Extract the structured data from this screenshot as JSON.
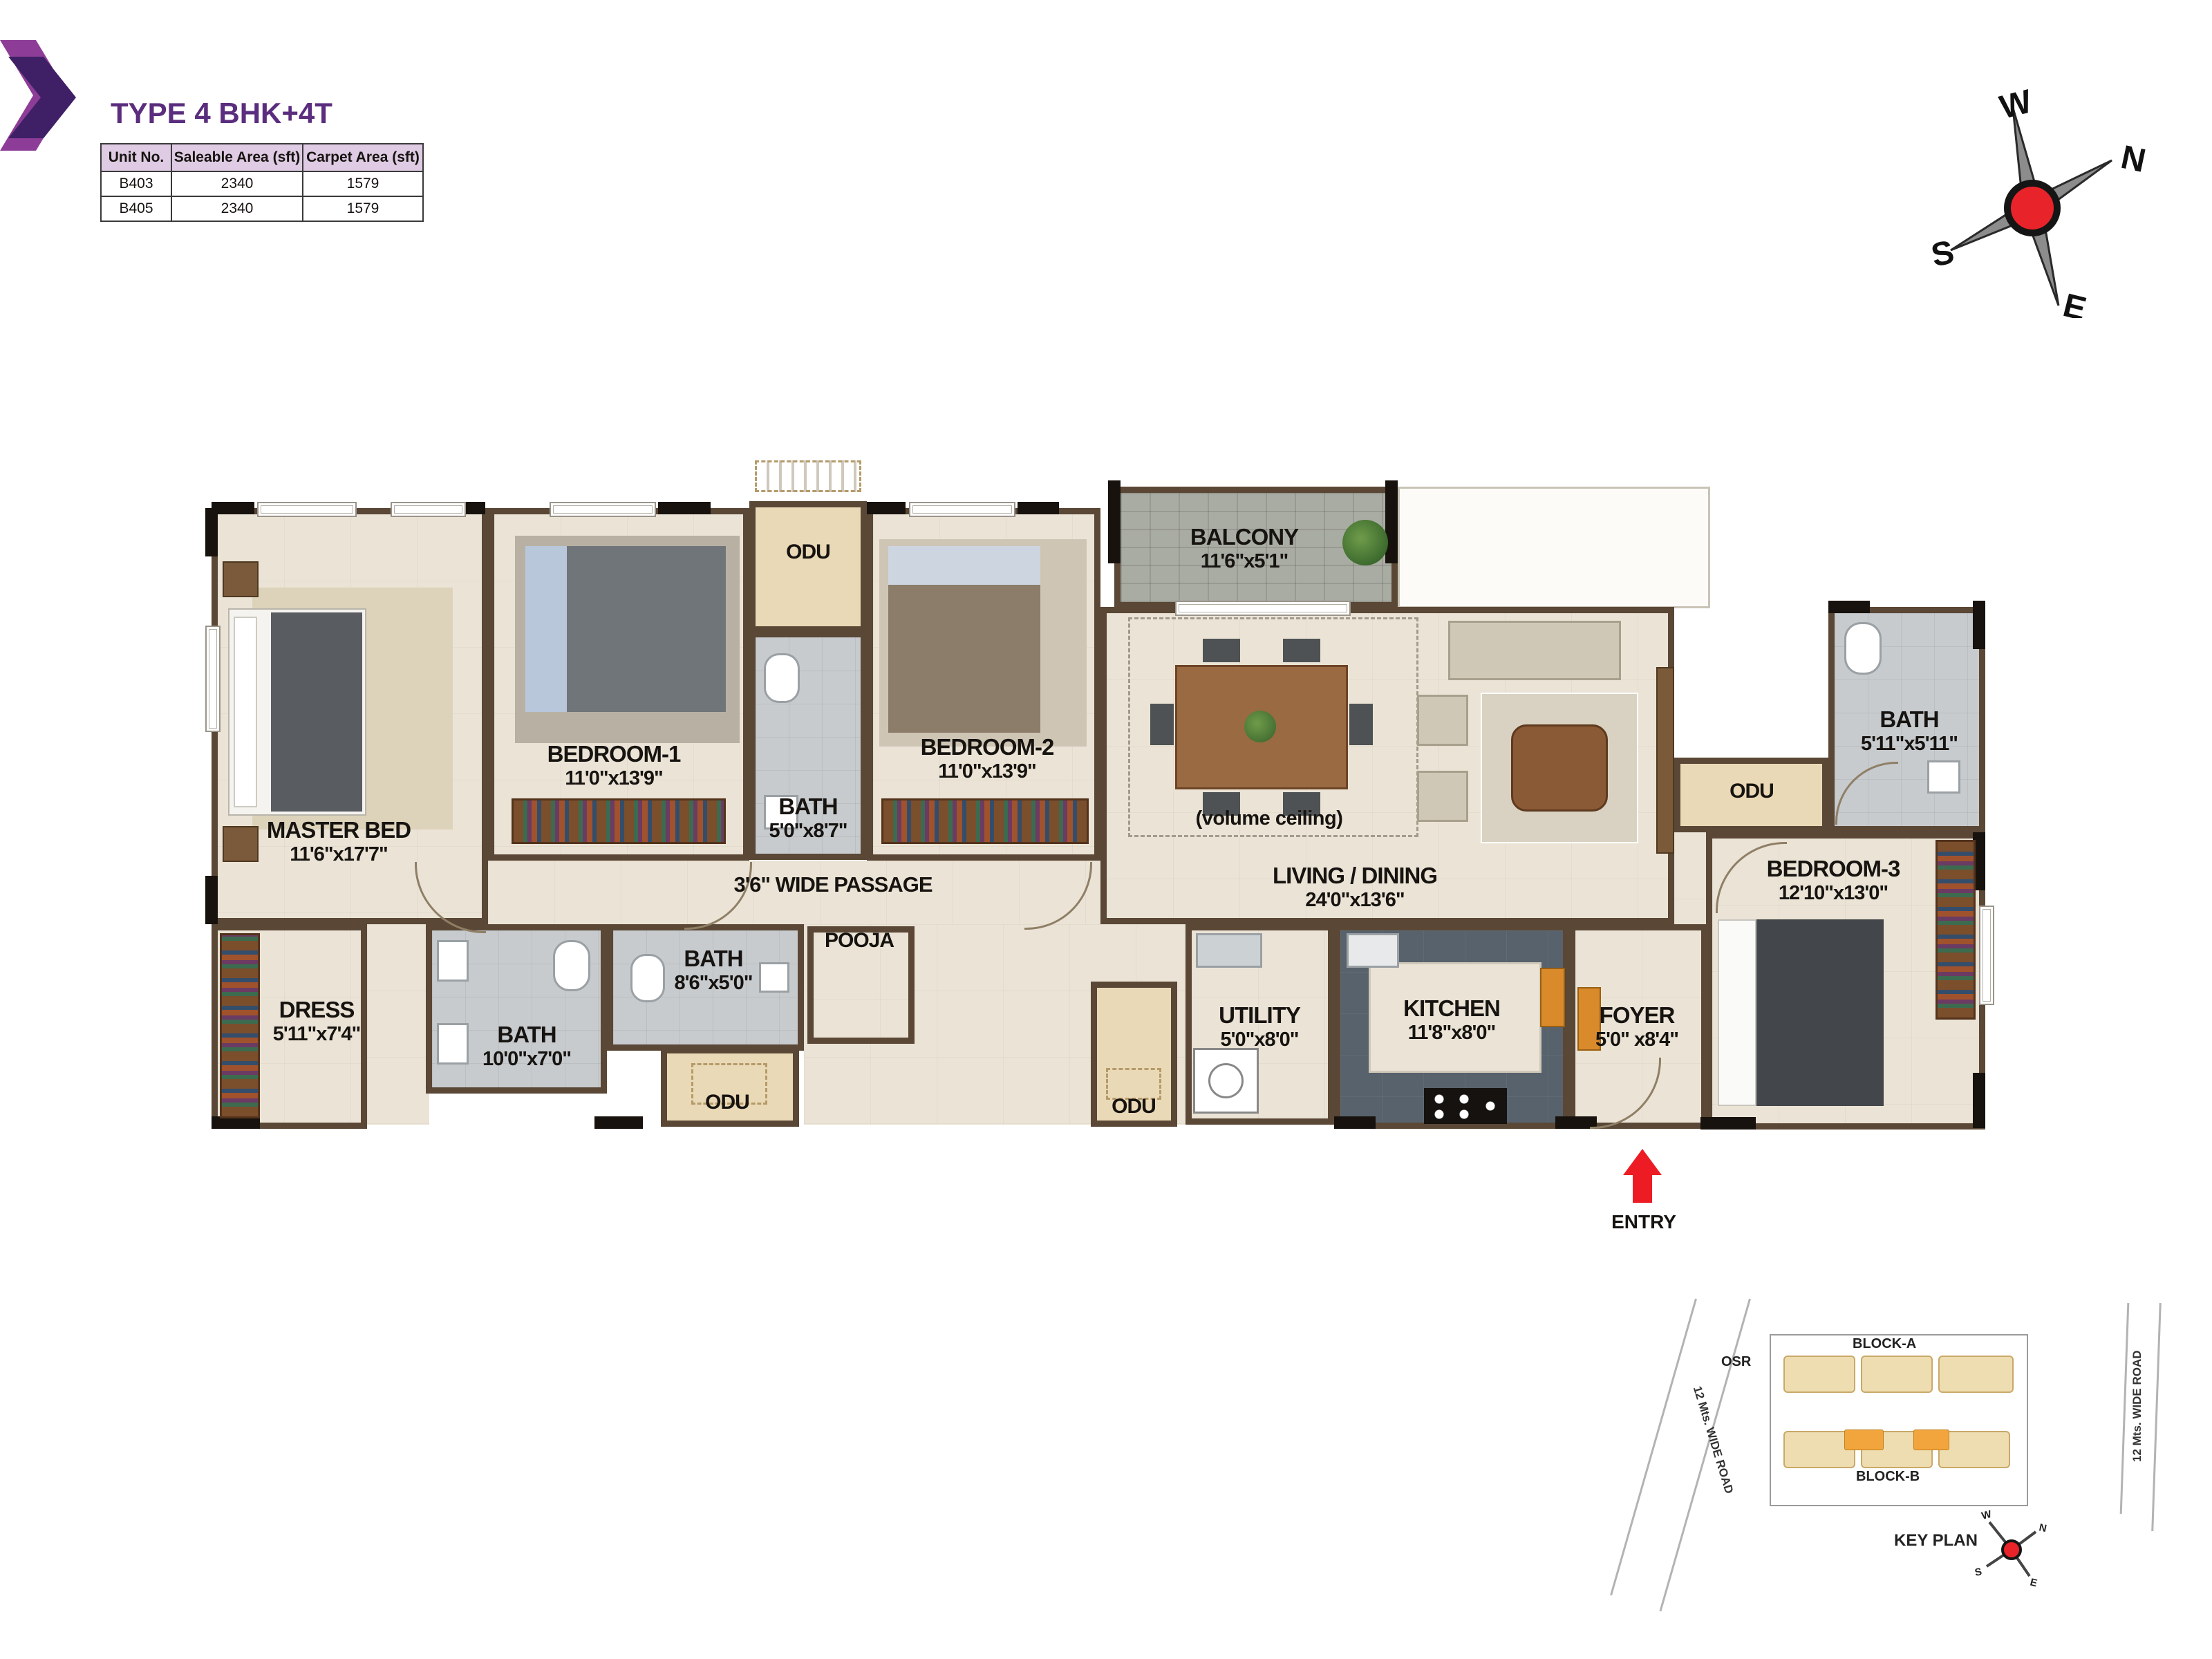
{
  "colors": {
    "accent_purple": "#5b2d7e",
    "table_header_bg": "#dfcbe3",
    "entry_red": "#ed1c24",
    "compass_red": "#e82329",
    "wall_brown": "#5a4735",
    "odu_beige": "#ead9b6",
    "bath_gray": "#c7cbce",
    "keyplan_highlight_orange": "#f2a53d"
  },
  "header": {
    "title": "TYPE 4 BHK+4T"
  },
  "table": {
    "headers": [
      "Unit No.",
      "Saleable Area (sft)",
      "Carpet Area (sft)"
    ],
    "rows": [
      [
        "B403",
        "2340",
        "1579"
      ],
      [
        "B405",
        "2340",
        "1579"
      ]
    ]
  },
  "compass": {
    "n": "N",
    "s": "S",
    "e": "E",
    "w": "W"
  },
  "plan": {
    "rooms": {
      "master_bed": {
        "name": "MASTER BED",
        "size": "11'6\"x17'7\""
      },
      "bedroom1": {
        "name": "BEDROOM-1",
        "size": "11'0\"x13'9\""
      },
      "bedroom2": {
        "name": "BEDROOM-2",
        "size": "11'0\"x13'9\""
      },
      "bedroom3": {
        "name": "BEDROOM-3",
        "size": "12'10\"x13'0\""
      },
      "bath_mid": {
        "name": "BATH",
        "size": "5'0\"x8'7\""
      },
      "bath_master": {
        "name": "BATH",
        "size": "10'0\"x7'0\""
      },
      "bath_common": {
        "name": "BATH",
        "size": "8'6\"x5'0\""
      },
      "bath3": {
        "name": "BATH",
        "size": "5'11\"x5'11\""
      },
      "balcony": {
        "name": "BALCONY",
        "size": "11'6\"x5'1\""
      },
      "living_dining": {
        "name": "LIVING / DINING",
        "size": "24'0\"x13'6\"",
        "note": "(volume ceiling)"
      },
      "passage": {
        "name": "3'6\" WIDE  PASSAGE"
      },
      "pooja": {
        "name": "POOJA"
      },
      "dress": {
        "name": "DRESS",
        "size": "5'11\"x7'4\""
      },
      "utility": {
        "name": "UTILITY",
        "size": "5'0\"x8'0\""
      },
      "kitchen": {
        "name": "KITCHEN",
        "size": "11'8\"x8'0\""
      },
      "foyer": {
        "name": "FOYER",
        "size": "5'0\" x8'4\""
      },
      "odu_top": {
        "name": "ODU"
      },
      "odu_left": {
        "name": "ODU"
      },
      "odu_mid": {
        "name": "ODU"
      },
      "odu_right": {
        "name": "ODU"
      }
    },
    "entry_label": "ENTRY"
  },
  "key_plan": {
    "title": "KEY PLAN",
    "block_a": "BLOCK-A",
    "block_b": "BLOCK-B",
    "osr": "OSR",
    "road_left": "12 Mts. WIDE ROAD",
    "road_right": "12 Mts. WIDE ROAD"
  }
}
